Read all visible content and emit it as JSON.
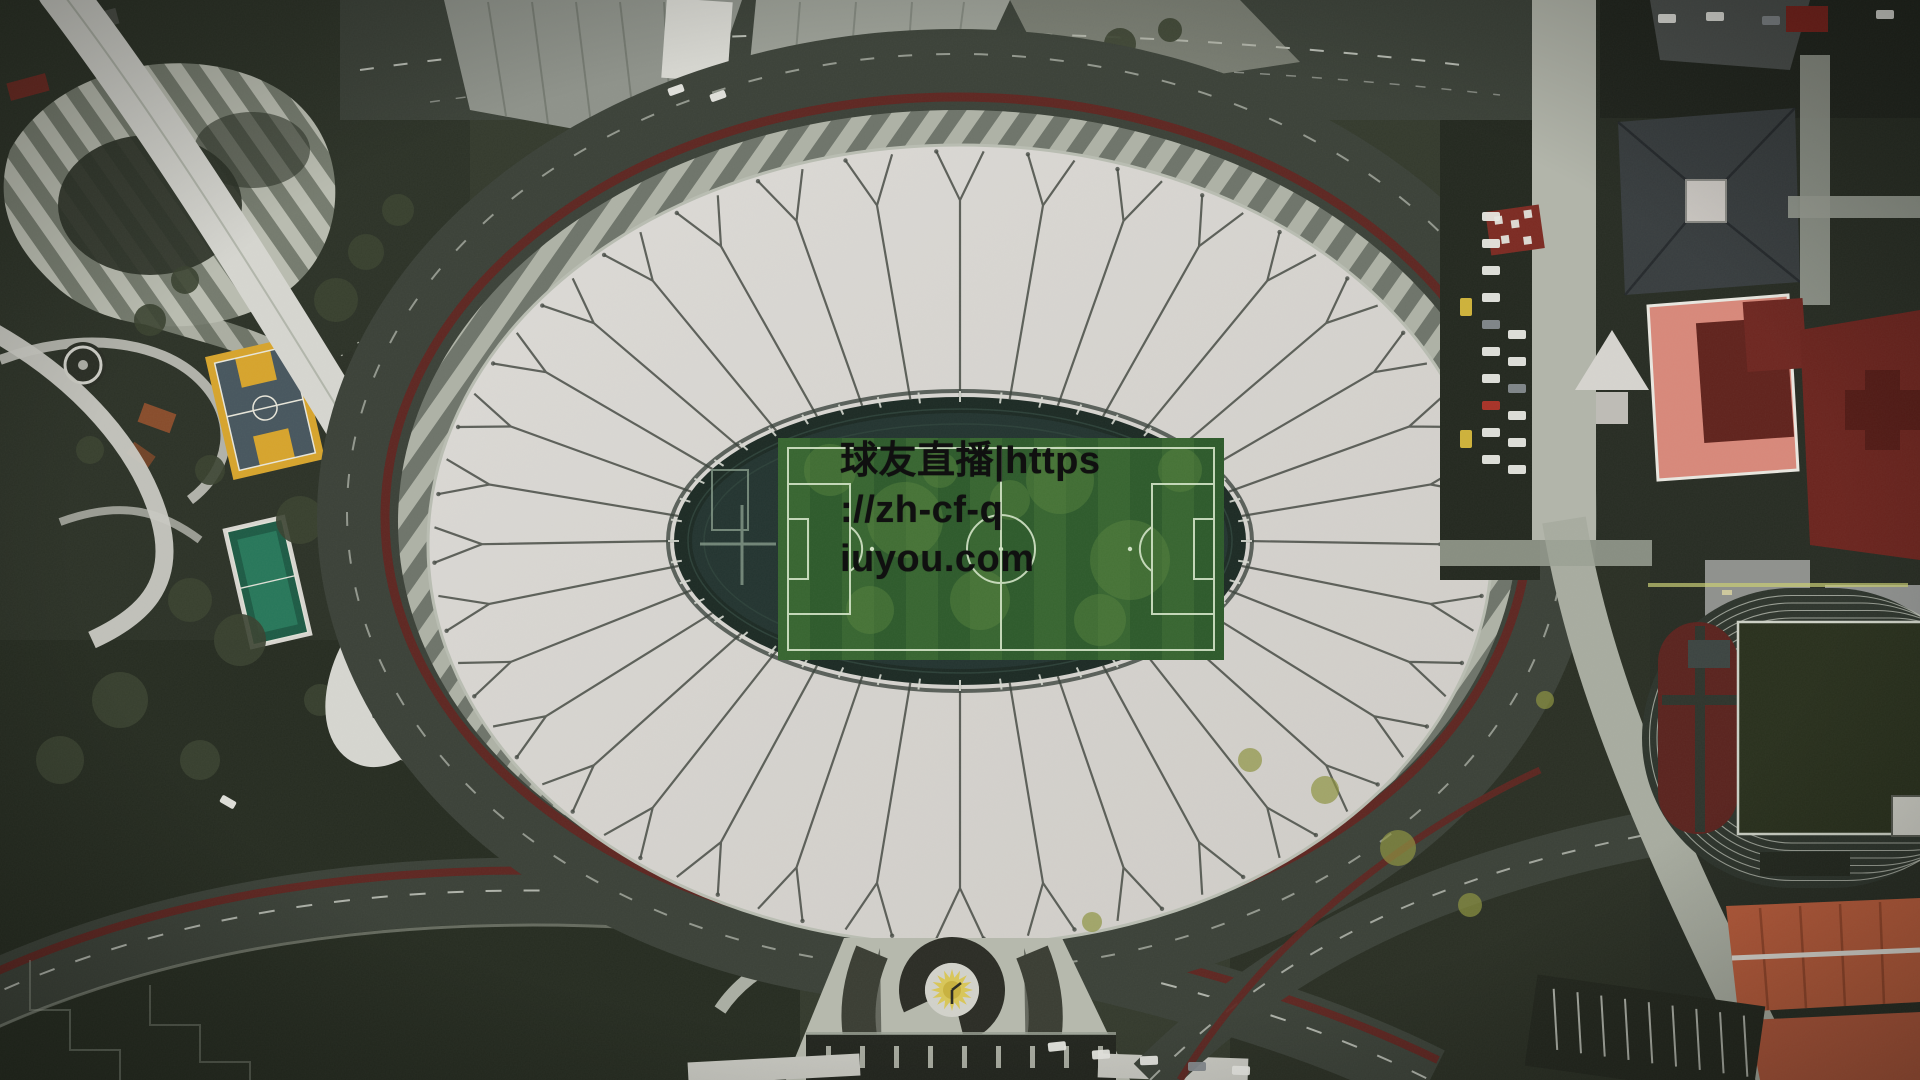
{
  "scene": {
    "type": "aerial-photograph",
    "alt": "Top-down aerial view of a large oval stadium with a white radial membrane roof, green football pitch at center, a dark-red jogging ring, striped concourses, curving white walkways and park courts on the left, and buildings with red, salmon and gray rooftops plus an athletics track on the right"
  },
  "watermark": {
    "line1": "球友直播|https",
    "line2": "://zh-cf-q",
    "line3": "iuyou.com",
    "full_text": "球友直播|https://zh-cf-qiuyou.com",
    "text_color": "#101010"
  },
  "palette": {
    "bg": "#343a2d",
    "bgDark": "#262c21",
    "bgRight": "#272c23",
    "asphalt": "#3b4138",
    "roadDash": "#cdd0c7",
    "walkway": "#d6d6d0",
    "walkwayDim": "#a8aca0",
    "zebraLight": "#aeb2a6",
    "zebraDark": "#6e746a",
    "zebra2Light": "#b9bcb0",
    "zebra2Dark": "#757b6e",
    "maroon": "#5e2621",
    "roof": "#d8d6d1",
    "roofEdge": "#b9bdb2",
    "roofSeam": "#454a43",
    "bowl": "#1c2a24",
    "trackIn": "#233430",
    "trackLine": "#31463d",
    "pitch": "#2d5a2b",
    "pitchStripe": "#3f7034",
    "pitchPatch": "#5d8a41",
    "pitchLine": "#d0e2c4",
    "tree": "#3a4130",
    "bush": "#8d9340",
    "plazaLight": "#b6b9ad",
    "plazaDark": "#4a4e44",
    "horseshoe": "#2b2c25",
    "sunYellow": "#d9c658",
    "sunCore": "#c9b23e",
    "disc": "#d2d2cb",
    "colonnade": "#22251e",
    "grayRoof": "#8e928a",
    "grayRoof2": "#989c93",
    "darkBuilding": "#383d3f",
    "darkBuildingEdge": "#23272a",
    "skylight": "#cdc9c4",
    "salmon": "#d8887a",
    "redDeep": "#60221c",
    "redRoof": "#6b241e",
    "redBright": "#7c2a22",
    "orangeRoof": "#b65a3a",
    "orangeRidge": "#8e4228",
    "fieldGreen": "#29301d",
    "trackOut": "#2d342c",
    "laneLine": "#c6cabf",
    "dzone": "#5a231e",
    "courtYellow": "#d7a42c",
    "courtSurface": "#47565e",
    "futsalDark": "#1d5b45",
    "futsalLight": "#27775a",
    "carWhite": "#e8e8e3",
    "carGray": "#858a8e",
    "carYellow": "#d8b93c",
    "carRed": "#b03328",
    "ink": "#101010"
  }
}
